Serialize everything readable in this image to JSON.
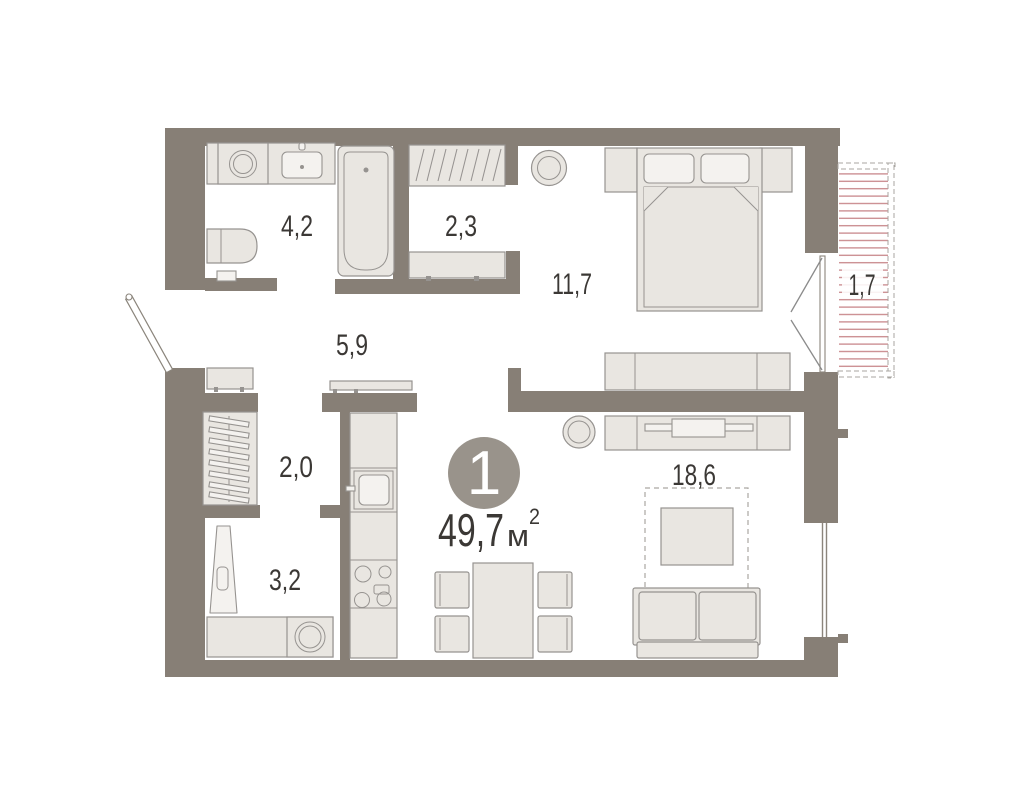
{
  "plan": {
    "unit": {
      "number": "1",
      "area_value": "49,7",
      "area_unit": "м",
      "area_superscript": "2"
    },
    "rooms": [
      {
        "name": "bathroom",
        "area": "4,2"
      },
      {
        "name": "dressing-room",
        "area": "2,3"
      },
      {
        "name": "bedroom",
        "area": "11,7"
      },
      {
        "name": "hallway",
        "area": "5,9"
      },
      {
        "name": "closet",
        "area": "2,0"
      },
      {
        "name": "laundry",
        "area": "3,2"
      },
      {
        "name": "living-kitchen",
        "area": "18,6"
      },
      {
        "name": "balcony",
        "area": "1,7"
      }
    ],
    "colors": {
      "wall": "#877f76",
      "furniture_fill": "#e9e6e1",
      "furniture_stroke": "#969390",
      "text": "#3b3835",
      "balcony_hatch": "#c8878a",
      "badge_fill": "#99938b",
      "badge_text": "#ffffff"
    }
  }
}
